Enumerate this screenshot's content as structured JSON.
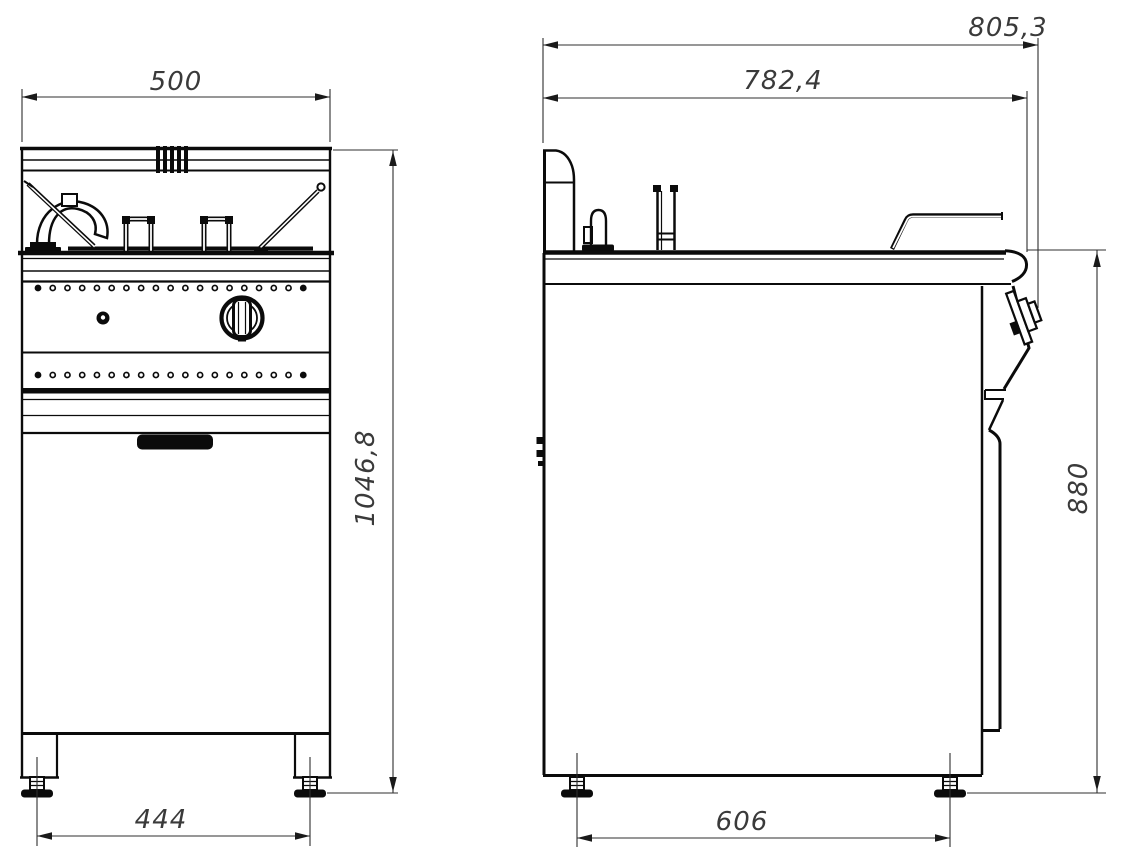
{
  "drawing": {
    "type": "technical-drawing-two-views",
    "colors": {
      "ink": "#0b0b0b",
      "dimension_text": "#3a3a3a",
      "background": "#ffffff"
    },
    "front_view": {
      "dim_width_top": "500",
      "dim_height_overall": "1046,8",
      "dim_feet_span": "444"
    },
    "side_view": {
      "dim_depth_overall": "805,3",
      "dim_depth_body": "782,4",
      "dim_height_worktop": "880",
      "dim_feet_span": "606"
    }
  }
}
